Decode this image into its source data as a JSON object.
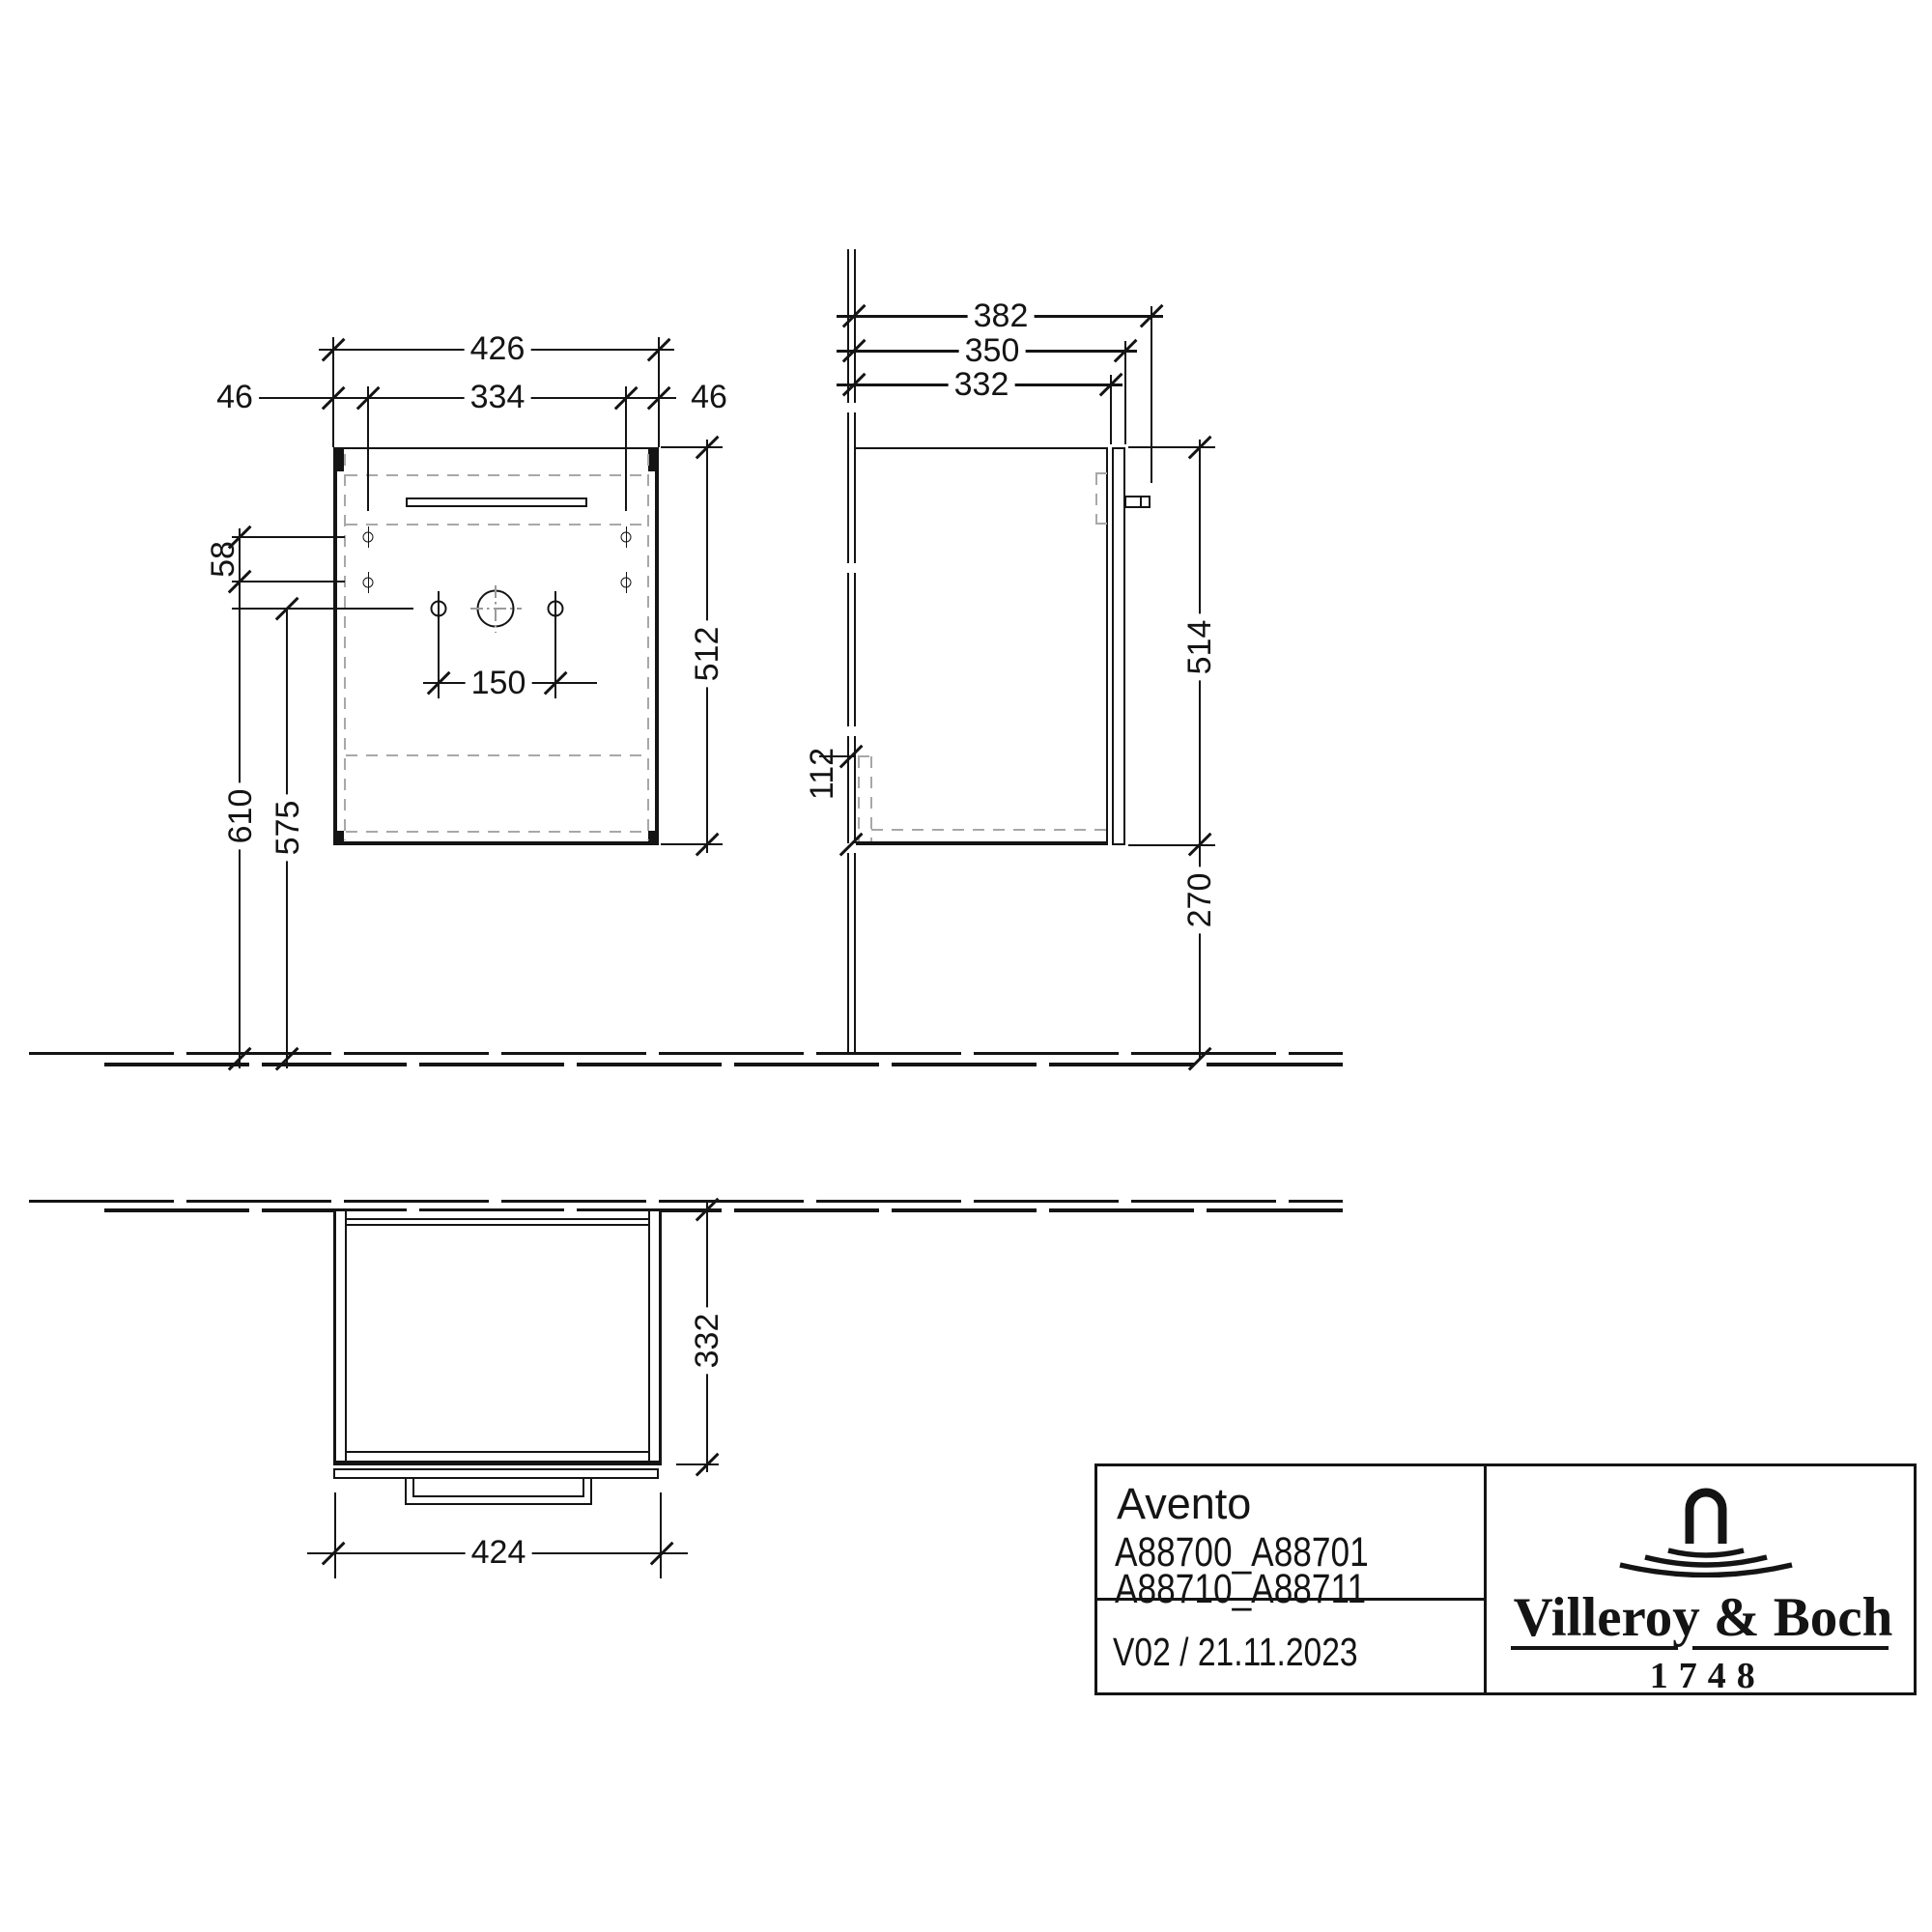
{
  "document_type": "technical-dimension-drawing",
  "colors": {
    "line": "#141414",
    "dashed": "#a8a8a8",
    "background": "#ffffff"
  },
  "dims": {
    "front": {
      "total_width": "426",
      "offset_left": "46",
      "hinge_span": "334",
      "offset_right": "46",
      "hole_row_gap": "58",
      "faucet_hole_span": "150",
      "height": "512",
      "floor_to_hinge_row": "610",
      "floor_to_faucet_row": "575"
    },
    "side": {
      "total_depth": "382",
      "door_depth": "350",
      "carcass_depth": "332",
      "height": "514",
      "floor_clearance": "270",
      "siphon_cutout_height": "112"
    },
    "plan": {
      "width": "424",
      "depth": "332"
    }
  },
  "title_block": {
    "product_name": "Avento",
    "article_codes": [
      "A88700_A88701",
      "A88710_A88711"
    ],
    "version_date": "V02 / 21.11.2023",
    "brand": {
      "name": "Villeroy & Boch",
      "founded_year": "1748",
      "logo_icon": "faucet-water-icon"
    }
  }
}
